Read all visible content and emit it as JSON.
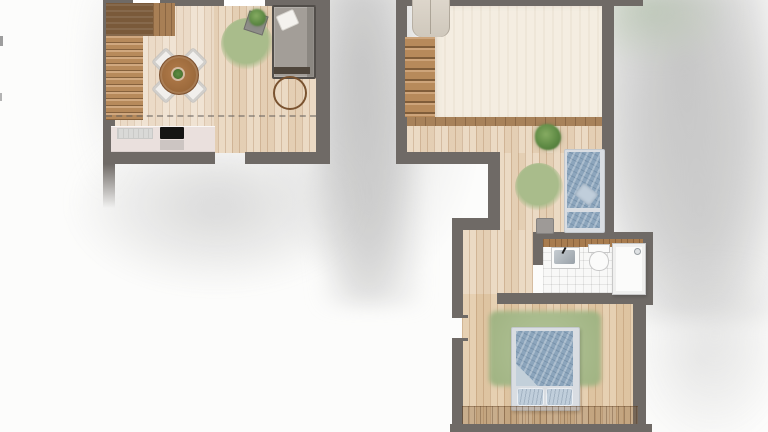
{
  "scene": {
    "kind": "architectural floor plan rendering, watercolor style, two levels, no text labels"
  },
  "colors": {
    "wall": "#6f6a66",
    "woodBase": "#e9d6bd",
    "woodBedroom": "#e3cba9",
    "paleRoom": "#f4ede1",
    "stairWood": "#b78a5b",
    "stairDark": "#7a5a3a",
    "threshold": "#a8825a",
    "rugGreen": "#a9bc8b",
    "plantGreen": "#5e8a44",
    "sofaGray": "#a39e98",
    "sofaFrame": "#524e4a",
    "tableWood": "#a46f3f",
    "counterPink": "#eae0dd",
    "cooktop": "#161514",
    "bedBlue": "#8ca5bc",
    "bedBlueLight": "#c0cedb",
    "bedFrame": "#d9dde2",
    "tile": "#f8f8f7",
    "fixtureBorder": "#c8c8c8",
    "bathCounter": "#a87c4f"
  },
  "floors": {
    "lower": {
      "label": "lower level - living / kitchen",
      "items": {
        "staircase": "staircase",
        "dining_table": "round dining table with plant",
        "chair": "dining chair",
        "rug": "round area rug",
        "plant": "potted plant",
        "sofa": "sofa with white cushion",
        "side_table": "round wooden side table",
        "counter": "kitchen counter",
        "cooktop": "black cooktop",
        "sink": "kitchen sink",
        "window": "window opening",
        "door": "door opening"
      }
    },
    "upper": {
      "label": "upper level - room / bath / bedroom",
      "items": {
        "staircase": "staircase with landing",
        "open_room": "large open room",
        "hallway": "wood hallway",
        "plant": "potted plant",
        "rug": "round area rug",
        "single_bed": "single bed with blue duvet",
        "stool": "small gray stool",
        "bath_counter": "wooden bathroom counter",
        "sink": "washbasin",
        "toilet": "toilet",
        "shower": "shower",
        "tiled_floor": "white tiled bathroom floor",
        "double_bed": "double bed with blue duvet and two pillows",
        "bed_rug": "green bedroom rug",
        "wardrobe": "low wooden band along bedroom wall",
        "door": "bedroom door opening"
      }
    }
  }
}
